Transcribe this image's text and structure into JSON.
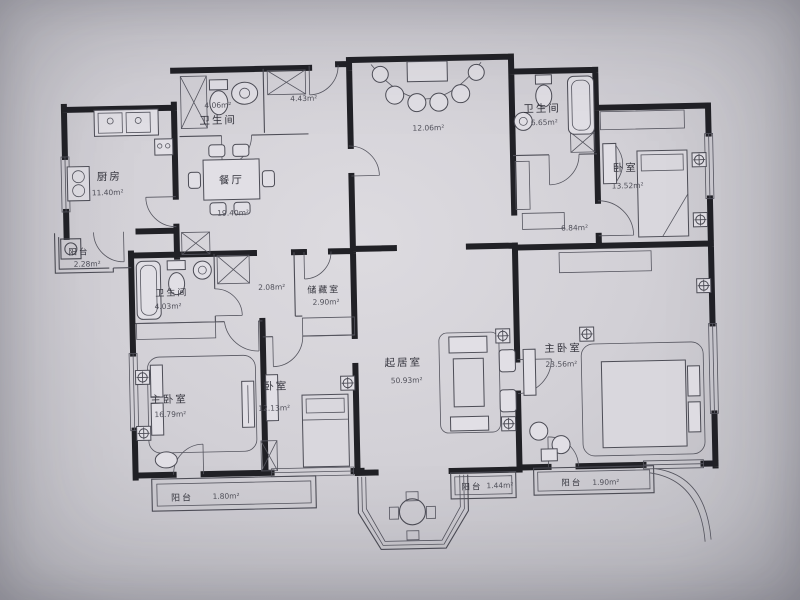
{
  "title": "apartment-floor-plan",
  "colors": {
    "background": "#cfced4",
    "paper": "#dad8dd",
    "wall": "#1e1e23",
    "line": "#4b4b55",
    "text": "#33333c"
  },
  "rooms": {
    "kitchen": {
      "name": "厨房",
      "area": "11.40m²"
    },
    "balcony_left": {
      "name": "阳台",
      "area": "2.28m²"
    },
    "bath_top": {
      "name": "卫生间",
      "area": "4.06m²"
    },
    "hall_entry": {
      "area": "4.43m²"
    },
    "dining": {
      "name": "餐厅",
      "area": "19.40m²"
    },
    "terrace": {
      "area": "12.06m²"
    },
    "bath_right": {
      "name": "卫生间",
      "area": "6.65m²"
    },
    "hall_right": {
      "area": "6.84m²"
    },
    "bedroom_right": {
      "name": "卧室",
      "area": "13.52m²"
    },
    "bath_mid": {
      "name": "卫生间",
      "area": "4.03m²"
    },
    "hall_mid": {
      "area": "2.08m²"
    },
    "storage": {
      "name": "储藏室",
      "area": "2.90m²"
    },
    "master_left": {
      "name": "主卧室",
      "area": "16.79m²"
    },
    "bedroom_mid": {
      "name": "卧室",
      "area": "12.13m²"
    },
    "living": {
      "name": "起居室",
      "area": "50.93m²"
    },
    "master_right": {
      "name": "主卧室",
      "area": "23.56m²"
    },
    "balcony_bl": {
      "name": "阳台",
      "area": "1.80m²"
    },
    "balcony_bm": {
      "name": "阳台",
      "area": "1.44m²"
    },
    "balcony_br": {
      "name": "阳台",
      "area": "1.90m²"
    }
  }
}
